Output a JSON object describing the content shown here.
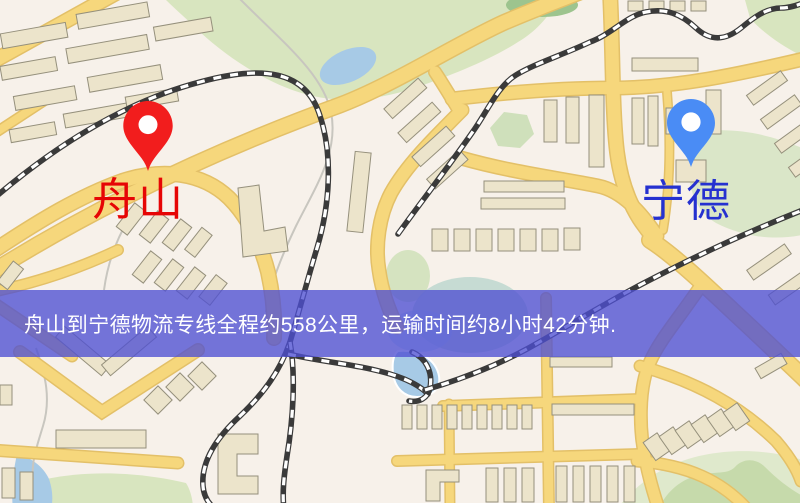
{
  "banner": {
    "text": "舟山到宁德物流专线全程约558公里，运输时间约8小时42分钟.",
    "background_color": "#4e50d2",
    "text_color": "#ffffff"
  },
  "route": {
    "origin": "舟山",
    "destination": "宁德",
    "distance_text": "约558公里",
    "duration_text": "约8小时42分钟"
  },
  "markers": [
    {
      "id": "origin",
      "label": "舟山",
      "label_color": "#e60505",
      "pin_color": "#f21d1d",
      "icon": "location-pin-icon"
    },
    {
      "id": "destination",
      "label": "宁德",
      "label_color": "#2531d0",
      "pin_color": "#4a8cf5",
      "icon": "location-pin-icon"
    }
  ],
  "map_palette": {
    "background": "#f7f1ea",
    "road": "#f6d77c",
    "road_casing": "#e3c068",
    "building": "#ece4cb",
    "building_outline": "#95907c",
    "park": "#d8e5bf",
    "water": "#a7cae6",
    "railway": "#3a3a3a"
  }
}
